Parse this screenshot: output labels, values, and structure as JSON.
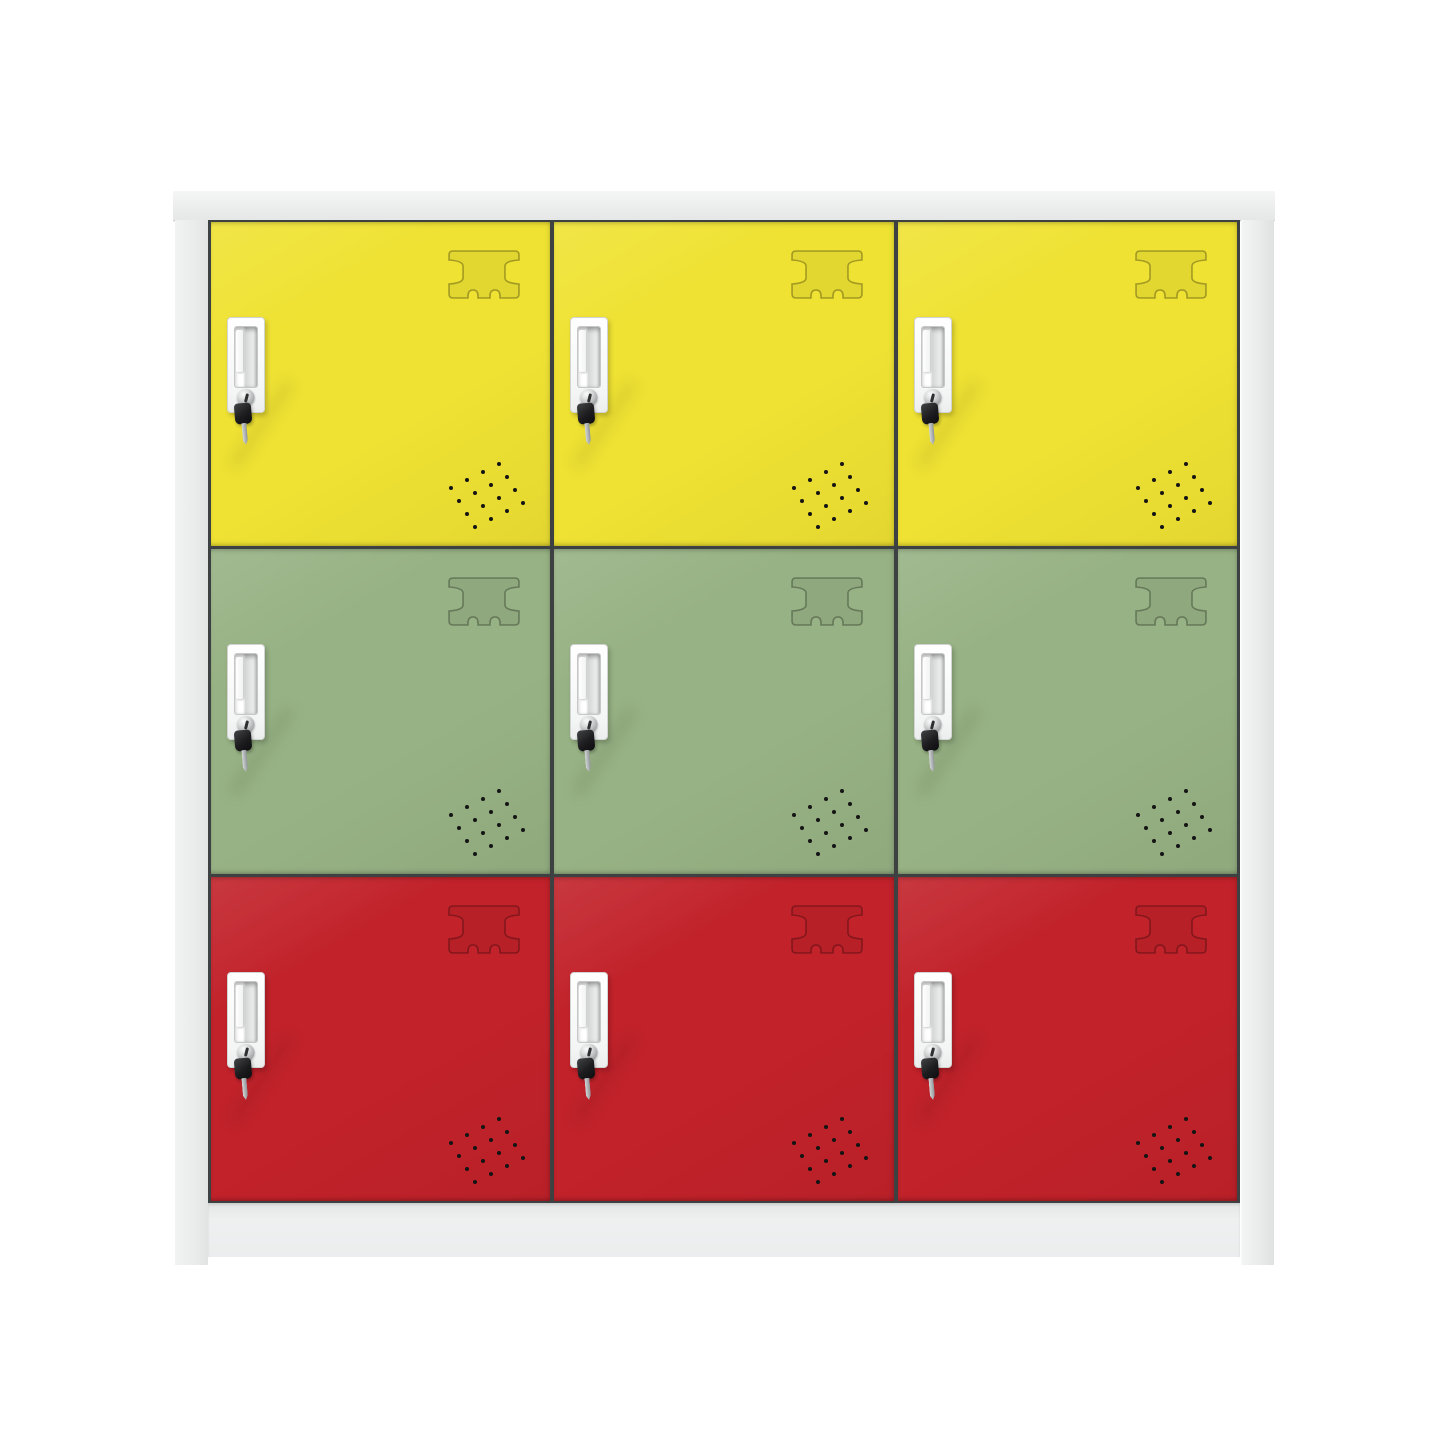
{
  "image": {
    "type": "product-photo",
    "subject": "9-door metal storage locker cabinet, 3 by 3 grid",
    "background_color": "#ffffff"
  },
  "cabinet": {
    "frame": {
      "name": "light-gray steel frame",
      "color": "#eceded",
      "edge_color": "#c9caca",
      "gap_color": "#3e4142"
    },
    "columns": 3,
    "rows": [
      {
        "name": "yellow locker row",
        "door_color": "#efe233"
      },
      {
        "name": "green locker row",
        "door_color": "#97b284"
      },
      {
        "name": "red locker row",
        "door_color": "#c2222a"
      }
    ],
    "door_features": {
      "label_emboss": {
        "name": "stamped label-holder recess",
        "outline": "rgba(0,0,0,0.30)",
        "fill": "rgba(0,0,0,0.05)"
      },
      "handle": {
        "name": "recessed white pull handle with cam lock and hanging key",
        "plate_color": "#ffffff",
        "recess_color": "#dfe1e1",
        "lock_color": "#c9cccd",
        "key_head_color": "#1a1a1c",
        "key_blade_color": "#b9bdbf"
      },
      "perforation": {
        "name": "diagonal ventilation holes",
        "rows": 4,
        "cols": 4,
        "hole_color": "#141414"
      }
    }
  }
}
